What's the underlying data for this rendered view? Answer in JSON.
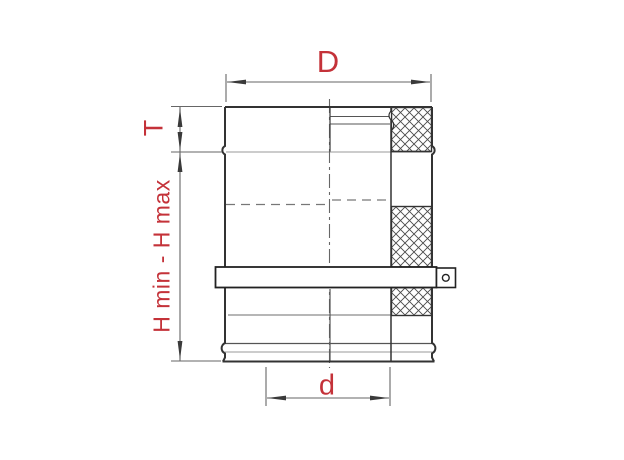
{
  "drawing": {
    "labels": {
      "outer_diameter": "D",
      "top_section_height": "T",
      "height_range": "H min - H max",
      "inner_diameter": "d"
    },
    "colors": {
      "label_red": "#c43239",
      "outline_dark": "#333333",
      "dimension_gray": "#666666",
      "light_gray": "#999999",
      "background": "#ffffff"
    }
  }
}
